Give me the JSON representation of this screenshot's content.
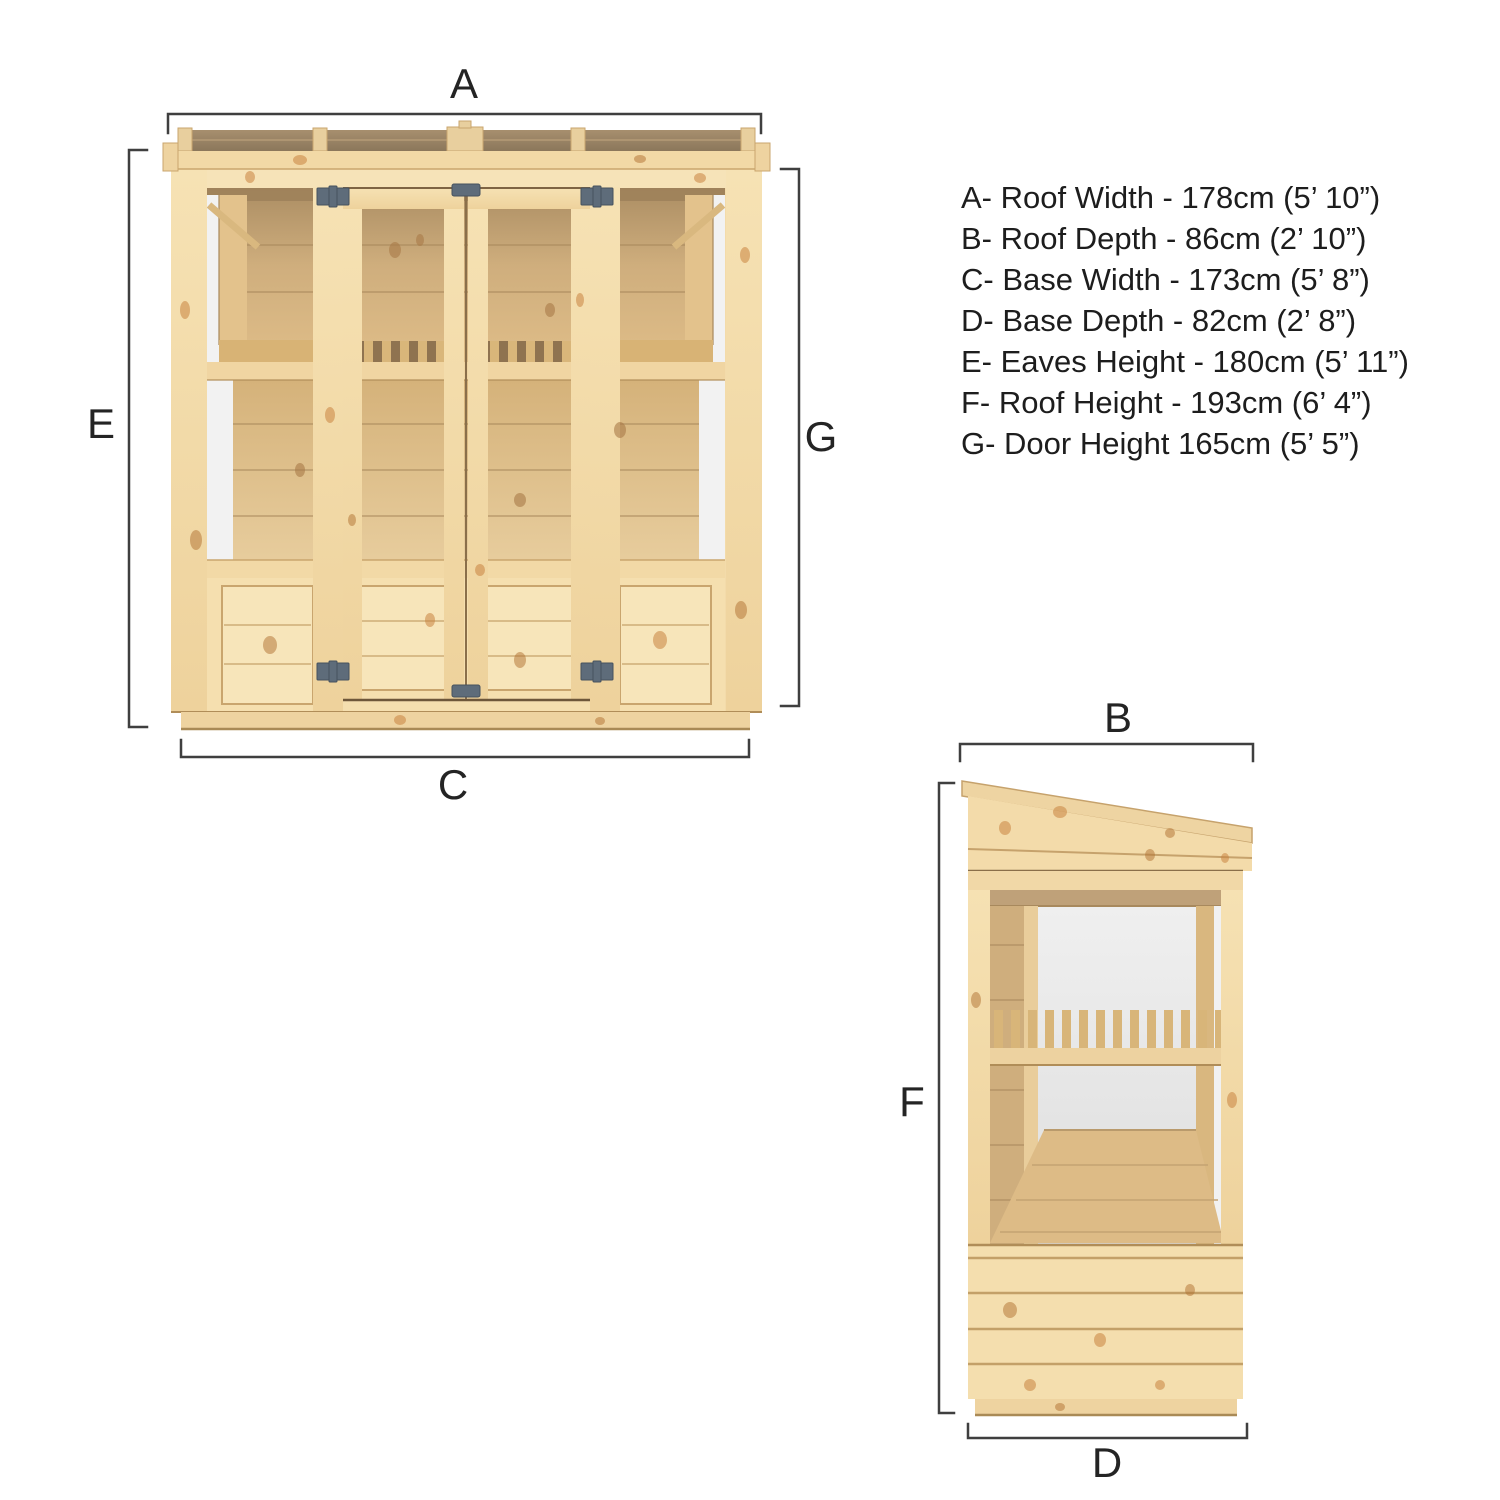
{
  "palette": {
    "wood": "#f3dbaa",
    "wood-light": "#f6e3b8",
    "wood-dark": "#e4c48e",
    "wood-edge": "#c9a56e",
    "wood-line": "#b08d58",
    "back-wall": "#dcba84",
    "back-wall-dark": "#a1845c",
    "shelf-wood": "#d8b375",
    "glass-white": "#f2f2f2",
    "interior-white": "#ececec",
    "hardware": "#5e6c7a",
    "dim-line": "#3f3f3f",
    "label-text": "#242424",
    "knot": "#c98440"
  },
  "front_view": {
    "callouts": {
      "roof_width": "A",
      "eaves_height": "E",
      "door_height": "G",
      "base_width": "C"
    }
  },
  "side_view": {
    "callouts": {
      "roof_depth": "B",
      "roof_height": "F",
      "base_depth": "D"
    }
  },
  "legend": {
    "items": [
      "A- Roof Width - 178cm (5’ 10”)",
      "B- Roof Depth - 86cm (2’ 10”)",
      "C- Base Width - 173cm (5’ 8”)",
      "D- Base Depth - 82cm (2’ 8”)",
      "E- Eaves Height - 180cm (5’ 11”)",
      "F- Roof Height - 193cm (6’ 4”)",
      "G- Door Height 165cm (5’ 5”)"
    ]
  }
}
